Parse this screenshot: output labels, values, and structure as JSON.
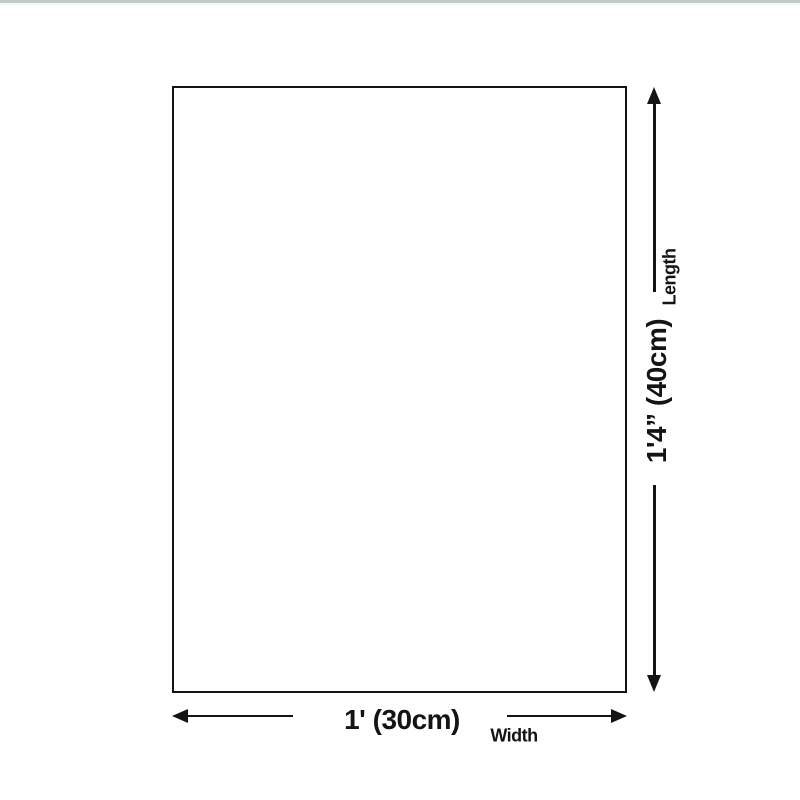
{
  "page": {
    "background": "#ffffff",
    "top_strip_color": "#c3caca"
  },
  "diagram": {
    "ink_color": "#141414",
    "length": {
      "value": "1'4” (40cm)",
      "axis_label": "Length"
    },
    "width": {
      "value": "1' (30cm)",
      "axis_label": "Width"
    }
  }
}
